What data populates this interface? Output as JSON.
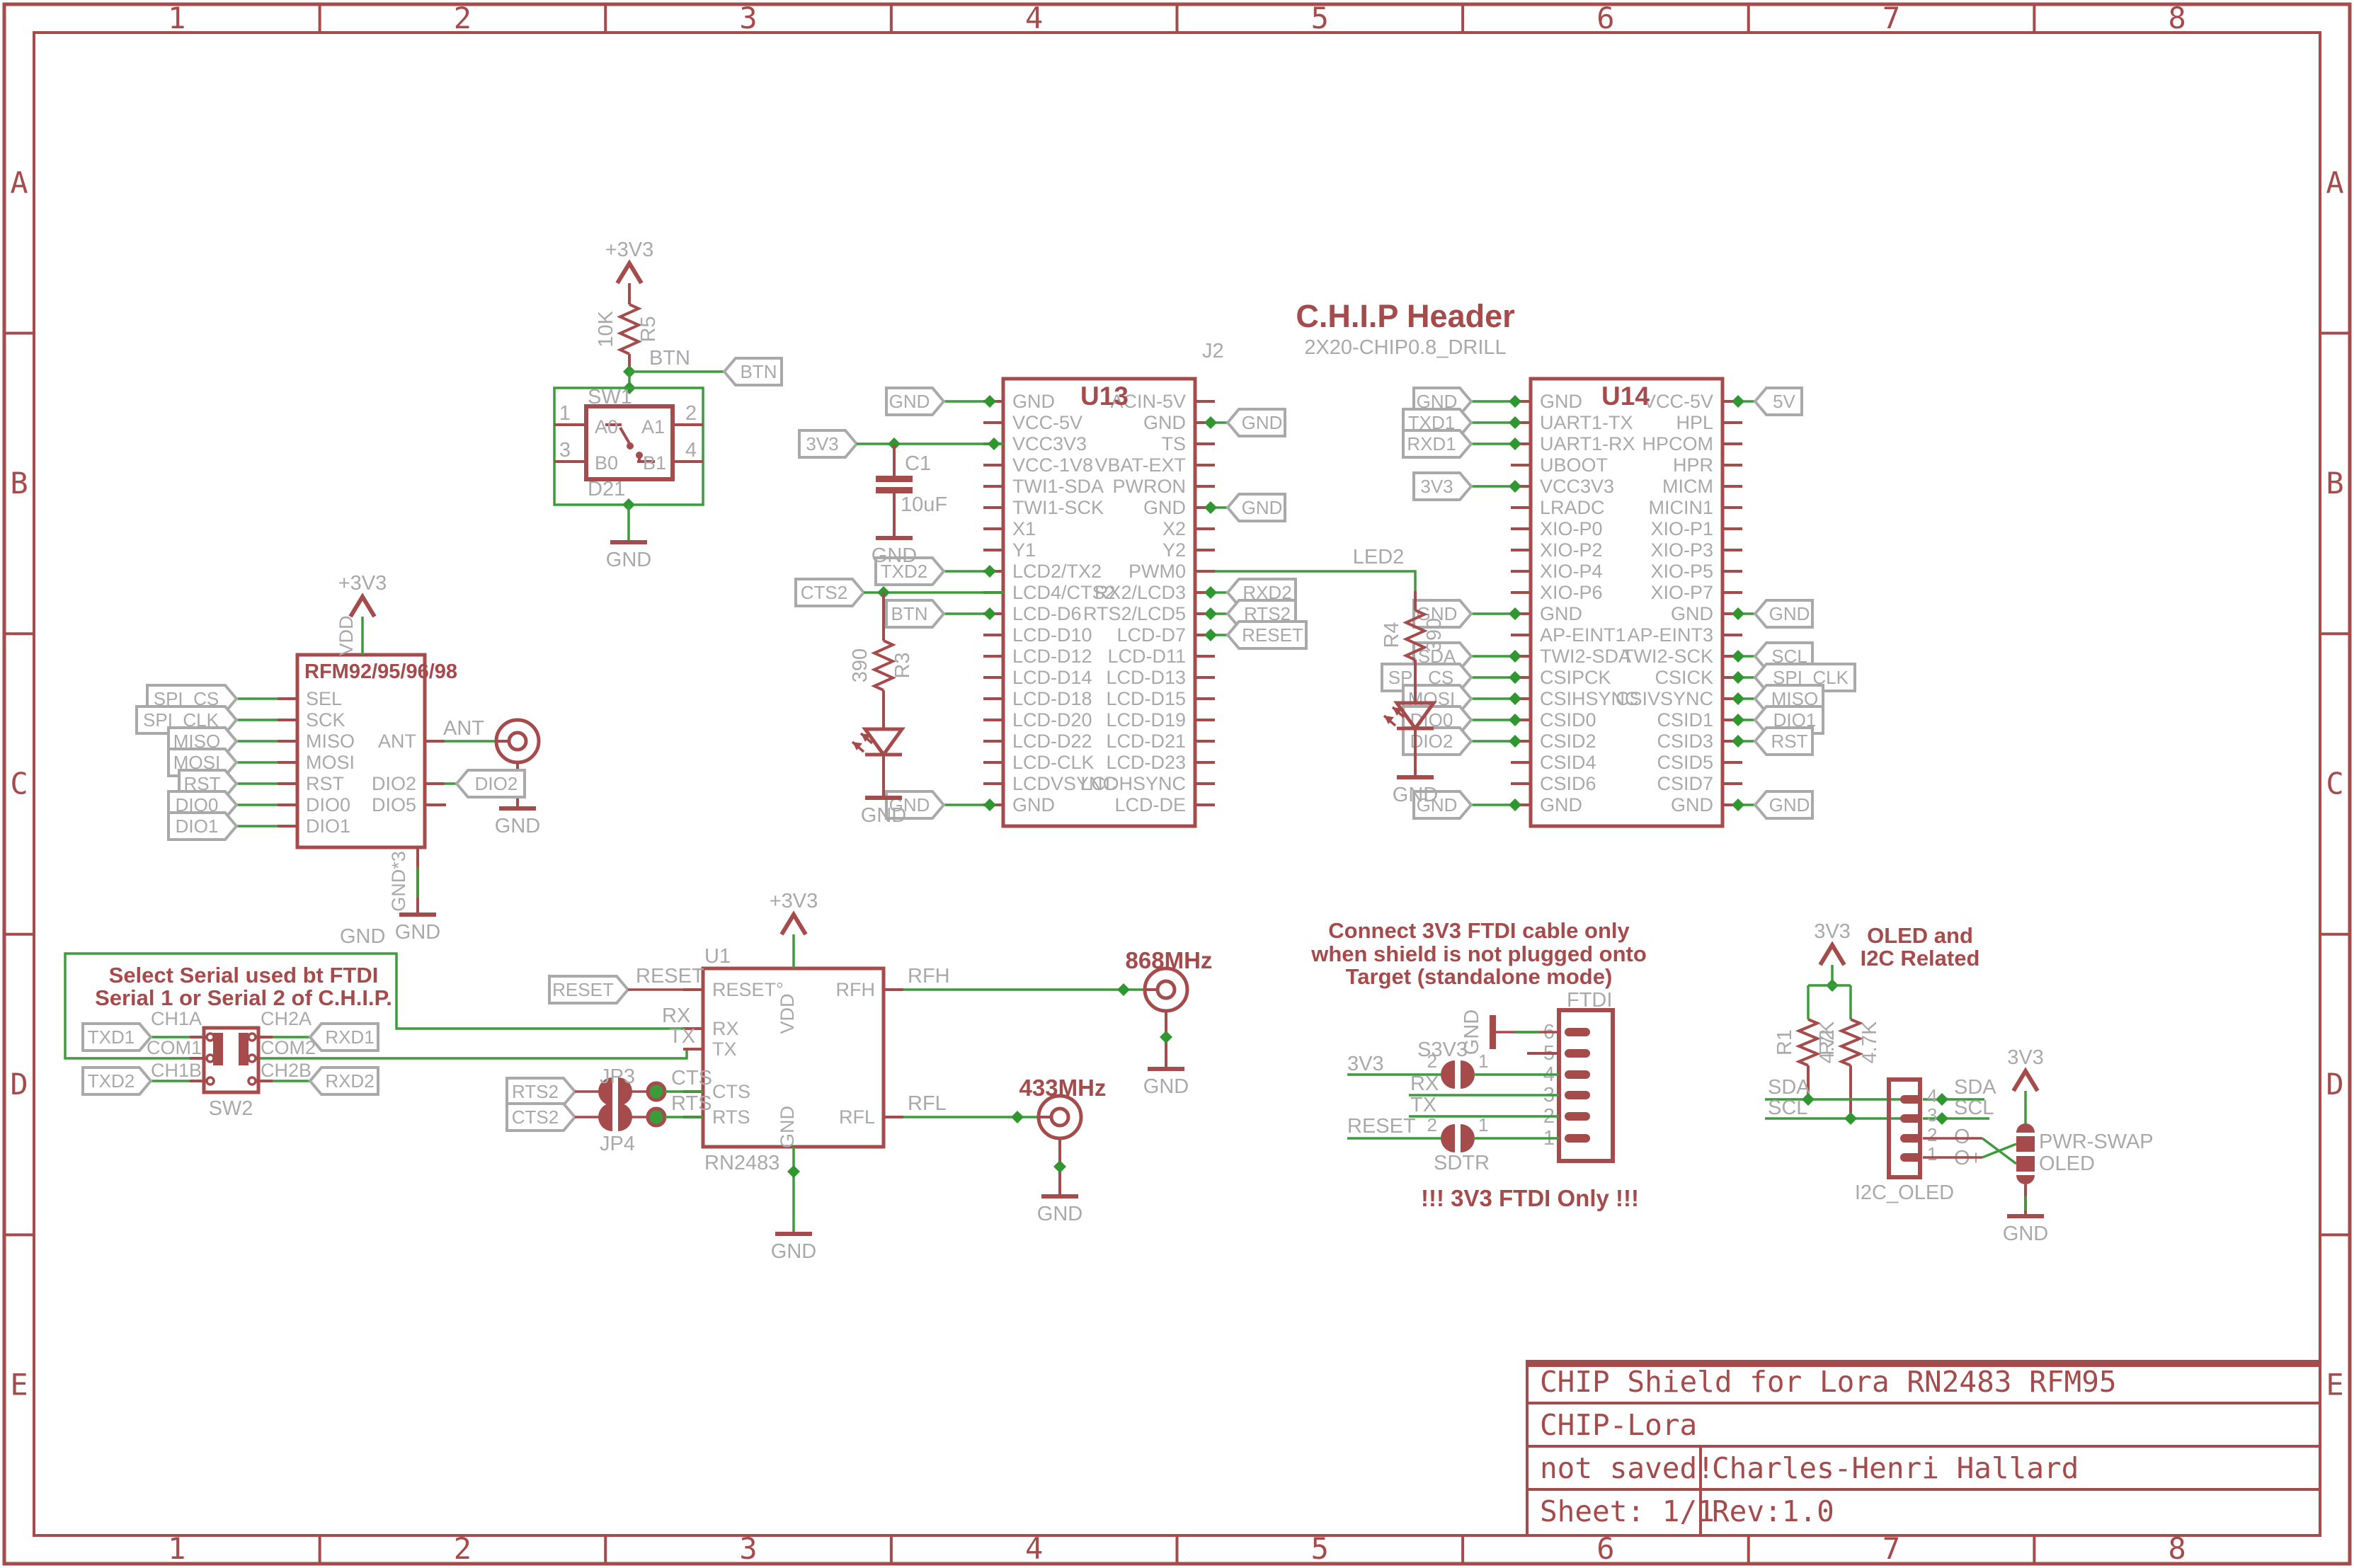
{
  "colors": {
    "maroon": "#a54b4b",
    "gray": "#a9a9a9",
    "wire_green": "#3c9c3c",
    "junction_green": "#2f9630",
    "background": "#ffffff"
  },
  "sheet": {
    "columns": [
      "1",
      "2",
      "3",
      "4",
      "5",
      "6",
      "7",
      "8"
    ],
    "rows": [
      "A",
      "B",
      "C",
      "D",
      "E"
    ]
  },
  "title_block": {
    "title": "CHIP Shield for Lora RN2483 RFM95",
    "project": "CHIP-Lora",
    "saved": "not saved!",
    "author": "Charles-Henri Hallard",
    "sheet": "Sheet: 1/1",
    "rev": "Rev:1.0"
  },
  "nets": {
    "gnd": "GND",
    "gnd3": "GND*3",
    "p3v3": "+3V3",
    "v3v3": "3V3",
    "v5": "5V",
    "btn": "BTN",
    "led2": "LED2",
    "ant": "ANT",
    "rfh": "RFH",
    "rfl": "RFL",
    "rx": "RX",
    "tx": "TX",
    "cts": "CTS",
    "rts": "RTS",
    "reset": "RESET",
    "sda": "SDA",
    "scl": "SCL",
    "txd1": "TXD1",
    "txd2": "TXD2",
    "rxd1": "RXD1",
    "rxd2": "RXD2",
    "rts2": "RTS2",
    "cts2": "CTS2",
    "spi_cs": "SPI_CS",
    "spi_clk": "SPI_CLK",
    "miso": "MISO",
    "mosi": "MOSI",
    "rst": "RST",
    "dio0": "DIO0",
    "dio1": "DIO1",
    "dio2": "DIO2",
    "vdd": "VDD",
    "o_minus": "O-",
    "o_plus": "O+"
  },
  "chip_header": {
    "title": "C.H.I.P  Header",
    "footprint": "2X20-CHIP0.8_DRILL",
    "ref": "J2"
  },
  "components": {
    "u13": {
      "ref": "U13",
      "left_pins": [
        "GND",
        "VCC-5V",
        "VCC3V3",
        "VCC-1V8",
        "TWI1-SDA",
        "TWI1-SCK",
        "X1",
        "Y1",
        "LCD2/TX2",
        "LCD4/CTS2",
        "LCD-D6",
        "LCD-D10",
        "LCD-D12",
        "LCD-D14",
        "LCD-D18",
        "LCD-D20",
        "LCD-D22",
        "LCD-CLK",
        "LCDVSYNC",
        "GND"
      ],
      "right_pins": [
        "ACIN-5V",
        "GND",
        "TS",
        "VBAT-EXT",
        "PWRON",
        "GND",
        "X2",
        "Y2",
        "PWM0",
        "RX2/LCD3",
        "RTS2/LCD5",
        "LCD-D7",
        "LCD-D11",
        "LCD-D13",
        "LCD-D15",
        "LCD-D19",
        "LCD-D21",
        "LCD-D23",
        "LCDHSYNC",
        "LCD-DE"
      ]
    },
    "u14": {
      "ref": "U14",
      "left_pins": [
        "GND",
        "UART1-TX",
        "UART1-RX",
        "UBOOT",
        "VCC3V3",
        "LRADC",
        "XIO-P0",
        "XIO-P2",
        "XIO-P4",
        "XIO-P6",
        "GND",
        "AP-EINT1",
        "TWI2-SDA",
        "CSIPCK",
        "CSIHSYNC",
        "CSID0",
        "CSID2",
        "CSID4",
        "CSID6",
        "GND"
      ],
      "right_pins": [
        "VCC-5V",
        "HPL",
        "HPCOM",
        "HPR",
        "MICM",
        "MICIN1",
        "XIO-P1",
        "XIO-P3",
        "XIO-P5",
        "XIO-P7",
        "GND",
        "AP-EINT3",
        "TWI2-SCK",
        "CSICK",
        "CSIVSYNC",
        "CSID1",
        "CSID3",
        "CSID5",
        "CSID7",
        "GND"
      ]
    },
    "rfm": {
      "ref": "RFM92/95/96/98",
      "left_pins": [
        "SEL",
        "SCK",
        "MISO",
        "MOSI",
        "RST",
        "DIO0",
        "DIO1"
      ],
      "right_pins": [
        "ANT",
        "DIO2",
        "DIO5"
      ]
    },
    "u1": {
      "ref": "U1",
      "part": "RN2483",
      "pin_reset": "RESET°",
      "pin_rx": "RX",
      "pin_tx": "TX",
      "pin_cts": "CTS",
      "pin_rts": "RTS",
      "pin_vdd": "VDD",
      "pin_gnd": "GND",
      "pin_rfh": "RFH",
      "pin_rfl": "RFL"
    },
    "r5": {
      "ref": "R5",
      "value": "10K"
    },
    "r3": {
      "ref": "R3",
      "value": "390"
    },
    "r4": {
      "ref": "R4",
      "value": "390"
    },
    "r1": {
      "ref": "R1",
      "value": "4.7K"
    },
    "r2": {
      "ref": "R2",
      "value": "4.7K"
    },
    "c1": {
      "ref": "C1",
      "value": "10uF"
    },
    "sw1": {
      "ref": "SW1",
      "part": "D21",
      "pin_numbers": [
        "1",
        "2",
        "3",
        "4"
      ],
      "pin_labels": [
        "A0",
        "A1",
        "B0",
        "B1"
      ]
    },
    "sw2": {
      "ref": "SW2",
      "left_labels": [
        "CH1A",
        "COM1",
        "CH1B"
      ],
      "right_labels": [
        "CH2A",
        "COM2",
        "CH2B"
      ]
    },
    "jp3": {
      "ref": "JP3"
    },
    "jp4": {
      "ref": "JP4"
    },
    "ftdi": {
      "ref": "FTDI",
      "pin_numbers": [
        "6",
        "5",
        "4",
        "3",
        "2",
        "1"
      ],
      "s3v3": {
        "ref": "S3V3",
        "left_num": "2",
        "right_num": "1"
      },
      "sdtr": {
        "ref": "SDTR",
        "left_num": "2",
        "right_num": "1"
      }
    },
    "i2c_oled": {
      "ref": "I2C_OLED",
      "pin_numbers": [
        "4",
        "3",
        "2",
        "1"
      ]
    },
    "pwr_swap": {
      "ref": "PWR-SWAP",
      "part": "OLED"
    },
    "ant868": {
      "label": "868MHz"
    },
    "ant433": {
      "label": "433MHz"
    }
  },
  "notes": {
    "serial_select_1": "Select Serial used bt FTDI",
    "serial_select_2": "Serial 1 or Serial 2 of C.H.I.P.",
    "ftdi_warn_1": "Connect 3V3 FTDI cable only",
    "ftdi_warn_2": "when shield is not plugged onto",
    "ftdi_warn_3": "Target (standalone mode)",
    "ftdi_only": "!!! 3V3 FTDI Only !!!",
    "oled_1": "OLED and",
    "oled_2": "I2C Related"
  }
}
